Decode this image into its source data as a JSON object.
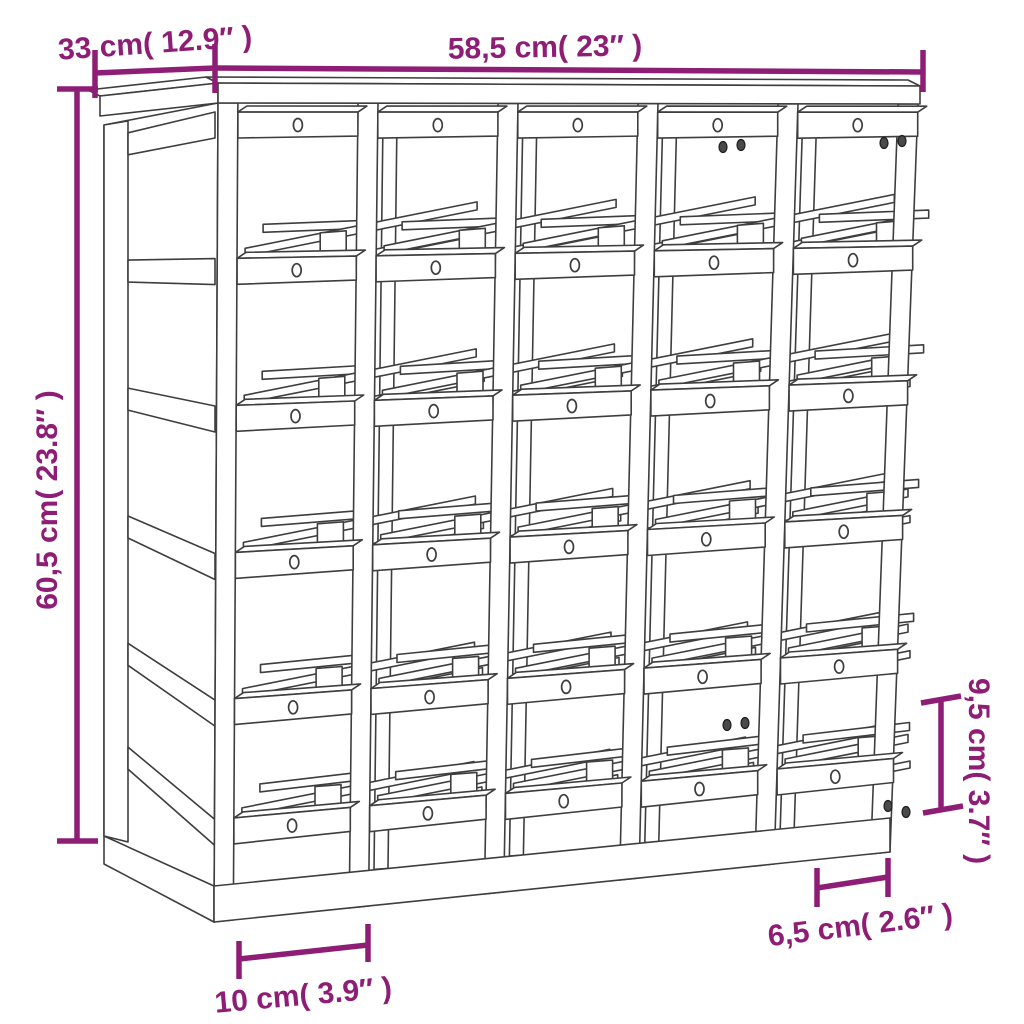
{
  "figure": {
    "type": "product dimension diagram",
    "subject": "wooden wine rack line drawing, 5 x 5 bottle slots, isometric view"
  },
  "colors": {
    "dimension_accent": "#8E1D76",
    "drawing_line": "#3E3E3E",
    "background": "#FFFFFF"
  },
  "dims": {
    "width": {
      "label": "58,5 cm( 23″ )"
    },
    "depth": {
      "label": "33 cm( 12.9″ )"
    },
    "height": {
      "label": "60,5 cm( 23.8″ )"
    },
    "slot_height": {
      "label": "9,5 cm( 3.7″ )"
    },
    "slot_spacing": {
      "label": "6,5 cm( 2.6″ )"
    },
    "base_depth": {
      "label": "10 cm( 3.9″ )"
    }
  }
}
